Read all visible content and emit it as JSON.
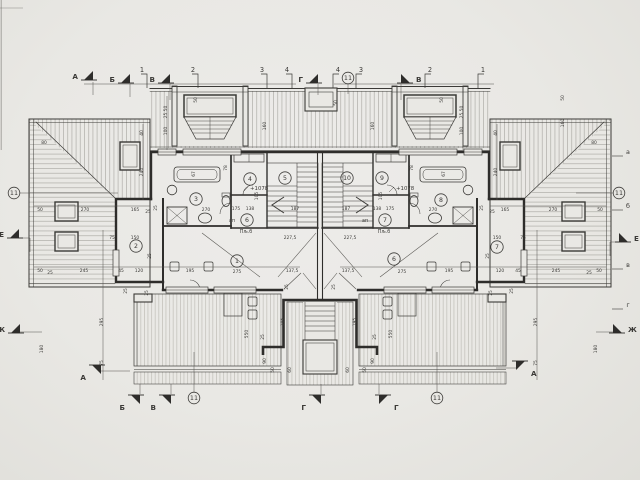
{
  "document": {
    "kind": "architectural floor plan (attic storey of symmetric duplex house)",
    "paper_color": "#e9e8e4",
    "line_color": "#3b3a37",
    "hatch_color": "#97958f"
  },
  "plan": {
    "room_numbers": [
      {
        "n": "1",
        "x": 237,
        "y": 261
      },
      {
        "n": "2",
        "x": 136,
        "y": 246
      },
      {
        "n": "3",
        "x": 196,
        "y": 199
      },
      {
        "n": "4",
        "x": 250,
        "y": 179
      },
      {
        "n": "5",
        "x": 285,
        "y": 178
      },
      {
        "n": "6",
        "x": 247,
        "y": 220
      },
      {
        "n": "6",
        "x": 394,
        "y": 259
      },
      {
        "n": "7",
        "x": 385,
        "y": 220
      },
      {
        "n": "7",
        "x": 497,
        "y": 247
      },
      {
        "n": "8",
        "x": 441,
        "y": 200
      },
      {
        "n": "9",
        "x": 382,
        "y": 178
      },
      {
        "n": "10",
        "x": 347,
        "y": 178
      }
    ],
    "detail_callouts": [
      {
        "n": "11",
        "x": 14,
        "y": 193
      },
      {
        "n": "11",
        "x": 348,
        "y": 78
      },
      {
        "n": "11",
        "x": 619,
        "y": 193
      },
      {
        "n": "11",
        "x": 194,
        "y": 398
      },
      {
        "n": "11",
        "x": 437,
        "y": 398
      }
    ],
    "grid_ticks": [
      {
        "t": "1",
        "x": 142,
        "d": 1
      },
      {
        "t": "2",
        "x": 193,
        "d": 1
      },
      {
        "t": "3",
        "x": 262,
        "d": 1
      },
      {
        "t": "4",
        "x": 287,
        "d": 1
      },
      {
        "t": "4",
        "x": 338,
        "d": -1
      },
      {
        "t": "3",
        "x": 361,
        "d": -1
      },
      {
        "t": "2",
        "x": 430,
        "d": -1
      },
      {
        "t": "1",
        "x": 483,
        "d": -1
      }
    ],
    "axis_letters_right": [
      {
        "t": "а",
        "y": 152
      },
      {
        "t": "б",
        "y": 206
      },
      {
        "t": "в",
        "y": 265
      },
      {
        "t": "г",
        "y": 305
      }
    ],
    "section_markers": [
      {
        "t": "А",
        "x": 84,
        "y": 76,
        "d": 1,
        "s": 1
      },
      {
        "t": "Б",
        "x": 121,
        "y": 79,
        "d": 1,
        "s": 1
      },
      {
        "t": "В",
        "x": 161,
        "y": 79,
        "d": 1,
        "s": 1
      },
      {
        "t": "Г",
        "x": 309,
        "y": 79,
        "d": 1,
        "s": 1
      },
      {
        "t": "В",
        "x": 410,
        "y": 79,
        "d": -1,
        "s": 1
      },
      {
        "t": "А",
        "x": 92,
        "y": 369,
        "d": 1,
        "s": -1
      },
      {
        "t": "Б",
        "x": 131,
        "y": 399,
        "d": 1,
        "s": -1
      },
      {
        "t": "В",
        "x": 162,
        "y": 399,
        "d": 1,
        "s": -1
      },
      {
        "t": "Г",
        "x": 312,
        "y": 399,
        "d": 1,
        "s": -1
      },
      {
        "t": "Г",
        "x": 388,
        "y": 399,
        "d": -1,
        "s": -1
      },
      {
        "t": "А",
        "x": 525,
        "y": 365,
        "d": -1,
        "s": -1
      },
      {
        "t": "Е",
        "x": 10,
        "y": 234,
        "d": 1,
        "s": 1
      },
      {
        "t": "Ж",
        "x": 11,
        "y": 329,
        "d": 1,
        "s": 1
      },
      {
        "t": "Е",
        "x": 628,
        "y": 238,
        "d": -1,
        "s": 1
      },
      {
        "t": "Ж",
        "x": 622,
        "y": 329,
        "d": -1,
        "s": 1
      }
    ],
    "elevation_labels": [
      {
        "t": "+1078",
        "x": 250,
        "y": 190
      },
      {
        "t": "+1078",
        "x": 396,
        "y": 190
      }
    ],
    "text_notes": [
      {
        "t": "ап",
        "x": 232,
        "y": 222,
        "cls": "note"
      },
      {
        "t": "Пљ.б",
        "x": 246,
        "y": 233,
        "cls": "note"
      },
      {
        "t": "ап",
        "x": 365,
        "y": 222,
        "cls": "note"
      },
      {
        "t": "Пљ.б",
        "x": 384,
        "y": 233,
        "cls": "note"
      }
    ],
    "dimensions": [
      {
        "t": "50",
        "x": 40,
        "y": 211
      },
      {
        "t": "270",
        "x": 85,
        "y": 211
      },
      {
        "t": "165",
        "x": 135,
        "y": 211
      },
      {
        "t": "25",
        "x": 148,
        "y": 213
      },
      {
        "t": "25",
        "x": 492,
        "y": 213
      },
      {
        "t": "165",
        "x": 505,
        "y": 211
      },
      {
        "t": "270",
        "x": 553,
        "y": 211
      },
      {
        "t": "50",
        "x": 600,
        "y": 211
      },
      {
        "t": "50",
        "x": 40,
        "y": 272
      },
      {
        "t": "25",
        "x": 50,
        "y": 274
      },
      {
        "t": "245",
        "x": 84,
        "y": 272
      },
      {
        "t": "45",
        "x": 121,
        "y": 272
      },
      {
        "t": "120",
        "x": 139,
        "y": 272
      },
      {
        "t": "195",
        "x": 190,
        "y": 272
      },
      {
        "t": "275",
        "x": 237,
        "y": 273
      },
      {
        "t": "137,5",
        "x": 292,
        "y": 272
      },
      {
        "t": "137,5",
        "x": 348,
        "y": 272
      },
      {
        "t": "275",
        "x": 402,
        "y": 273
      },
      {
        "t": "195",
        "x": 449,
        "y": 272
      },
      {
        "t": "120",
        "x": 500,
        "y": 272
      },
      {
        "t": "45",
        "x": 518,
        "y": 272
      },
      {
        "t": "245",
        "x": 556,
        "y": 272
      },
      {
        "t": "25",
        "x": 589,
        "y": 274
      },
      {
        "t": "50",
        "x": 599,
        "y": 272
      },
      {
        "t": "80",
        "x": 44,
        "y": 144
      },
      {
        "t": "80",
        "x": 594,
        "y": 144
      },
      {
        "t": "150",
        "x": 135,
        "y": 239
      },
      {
        "t": "75",
        "x": 112,
        "y": 239
      },
      {
        "t": "150",
        "x": 497,
        "y": 239
      },
      {
        "t": "75",
        "x": 523,
        "y": 239
      },
      {
        "t": "227,5",
        "x": 290,
        "y": 239
      },
      {
        "t": "227,5",
        "x": 350,
        "y": 239
      },
      {
        "t": "270",
        "x": 206,
        "y": 211
      },
      {
        "t": "270",
        "x": 433,
        "y": 211
      },
      {
        "t": "175",
        "x": 236,
        "y": 210
      },
      {
        "t": "138",
        "x": 250,
        "y": 210
      },
      {
        "t": "138",
        "x": 377,
        "y": 210
      },
      {
        "t": "175",
        "x": 390,
        "y": 210
      },
      {
        "t": "187",
        "x": 295,
        "y": 210
      },
      {
        "t": "187",
        "x": 346,
        "y": 210
      },
      {
        "t": "25 50",
        "x": 167,
        "y": 112,
        "r": 1
      },
      {
        "t": "100",
        "x": 167,
        "y": 131,
        "r": 1
      },
      {
        "t": "40",
        "x": 143,
        "y": 133,
        "r": 1
      },
      {
        "t": "240",
        "x": 143,
        "y": 172,
        "r": 1
      },
      {
        "t": "25",
        "x": 151,
        "y": 256,
        "r": 1
      },
      {
        "t": "50",
        "x": 197,
        "y": 100,
        "r": 1
      },
      {
        "t": "160",
        "x": 266,
        "y": 126,
        "r": 1
      },
      {
        "t": "50",
        "x": 337,
        "y": 103,
        "r": 1
      },
      {
        "t": "50",
        "x": 443,
        "y": 100,
        "r": 1
      },
      {
        "t": "160",
        "x": 374,
        "y": 126,
        "r": 1
      },
      {
        "t": "25 50",
        "x": 463,
        "y": 112,
        "r": 1
      },
      {
        "t": "100",
        "x": 463,
        "y": 131,
        "r": 1
      },
      {
        "t": "40",
        "x": 497,
        "y": 133,
        "r": 1
      },
      {
        "t": "240",
        "x": 497,
        "y": 172,
        "r": 1
      },
      {
        "t": "25",
        "x": 489,
        "y": 256,
        "r": 1
      },
      {
        "t": "50",
        "x": 564,
        "y": 98,
        "r": 1
      },
      {
        "t": "160",
        "x": 564,
        "y": 123,
        "r": 1
      },
      {
        "t": "295",
        "x": 103,
        "y": 322,
        "r": 1
      },
      {
        "t": "75",
        "x": 103,
        "y": 363,
        "r": 1
      },
      {
        "t": "295",
        "x": 537,
        "y": 322,
        "r": 1
      },
      {
        "t": "75",
        "x": 537,
        "y": 363,
        "r": 1
      },
      {
        "t": "180",
        "x": 43,
        "y": 349,
        "r": 1
      },
      {
        "t": "180",
        "x": 597,
        "y": 349,
        "r": 1
      },
      {
        "t": "550",
        "x": 248,
        "y": 334,
        "r": 1
      },
      {
        "t": "550",
        "x": 392,
        "y": 334,
        "r": 1
      },
      {
        "t": "90",
        "x": 266,
        "y": 361,
        "r": 1
      },
      {
        "t": "50",
        "x": 274,
        "y": 370,
        "r": 1
      },
      {
        "t": "90",
        "x": 374,
        "y": 361,
        "r": 1
      },
      {
        "t": "50",
        "x": 366,
        "y": 370,
        "r": 1
      },
      {
        "t": "195",
        "x": 284,
        "y": 322,
        "r": 1
      },
      {
        "t": "195",
        "x": 356,
        "y": 322,
        "r": 1
      },
      {
        "t": "25",
        "x": 264,
        "y": 337,
        "r": 1
      },
      {
        "t": "25",
        "x": 376,
        "y": 337,
        "r": 1
      },
      {
        "t": "60",
        "x": 291,
        "y": 370,
        "r": 1
      },
      {
        "t": "60",
        "x": 349,
        "y": 370,
        "r": 1
      },
      {
        "t": "25",
        "x": 288,
        "y": 287,
        "r": 1
      },
      {
        "t": "25",
        "x": 335,
        "y": 287,
        "r": 1
      },
      {
        "t": "25",
        "x": 127,
        "y": 291,
        "r": 1
      },
      {
        "t": "25",
        "x": 148,
        "y": 293,
        "r": 1
      },
      {
        "t": "25",
        "x": 492,
        "y": 293,
        "r": 1
      },
      {
        "t": "25",
        "x": 513,
        "y": 291,
        "r": 1
      },
      {
        "t": "105",
        "x": 258,
        "y": 196,
        "r": 1
      },
      {
        "t": "105",
        "x": 382,
        "y": 196,
        "r": 1
      },
      {
        "t": "67",
        "x": 195,
        "y": 174,
        "r": 1
      },
      {
        "t": "67",
        "x": 445,
        "y": 174,
        "r": 1
      },
      {
        "t": "78",
        "x": 227,
        "y": 168,
        "r": 1
      },
      {
        "t": "78",
        "x": 413,
        "y": 168,
        "r": 1
      },
      {
        "t": "25",
        "x": 157,
        "y": 208,
        "r": 1
      },
      {
        "t": "25",
        "x": 483,
        "y": 208,
        "r": 1
      }
    ]
  }
}
